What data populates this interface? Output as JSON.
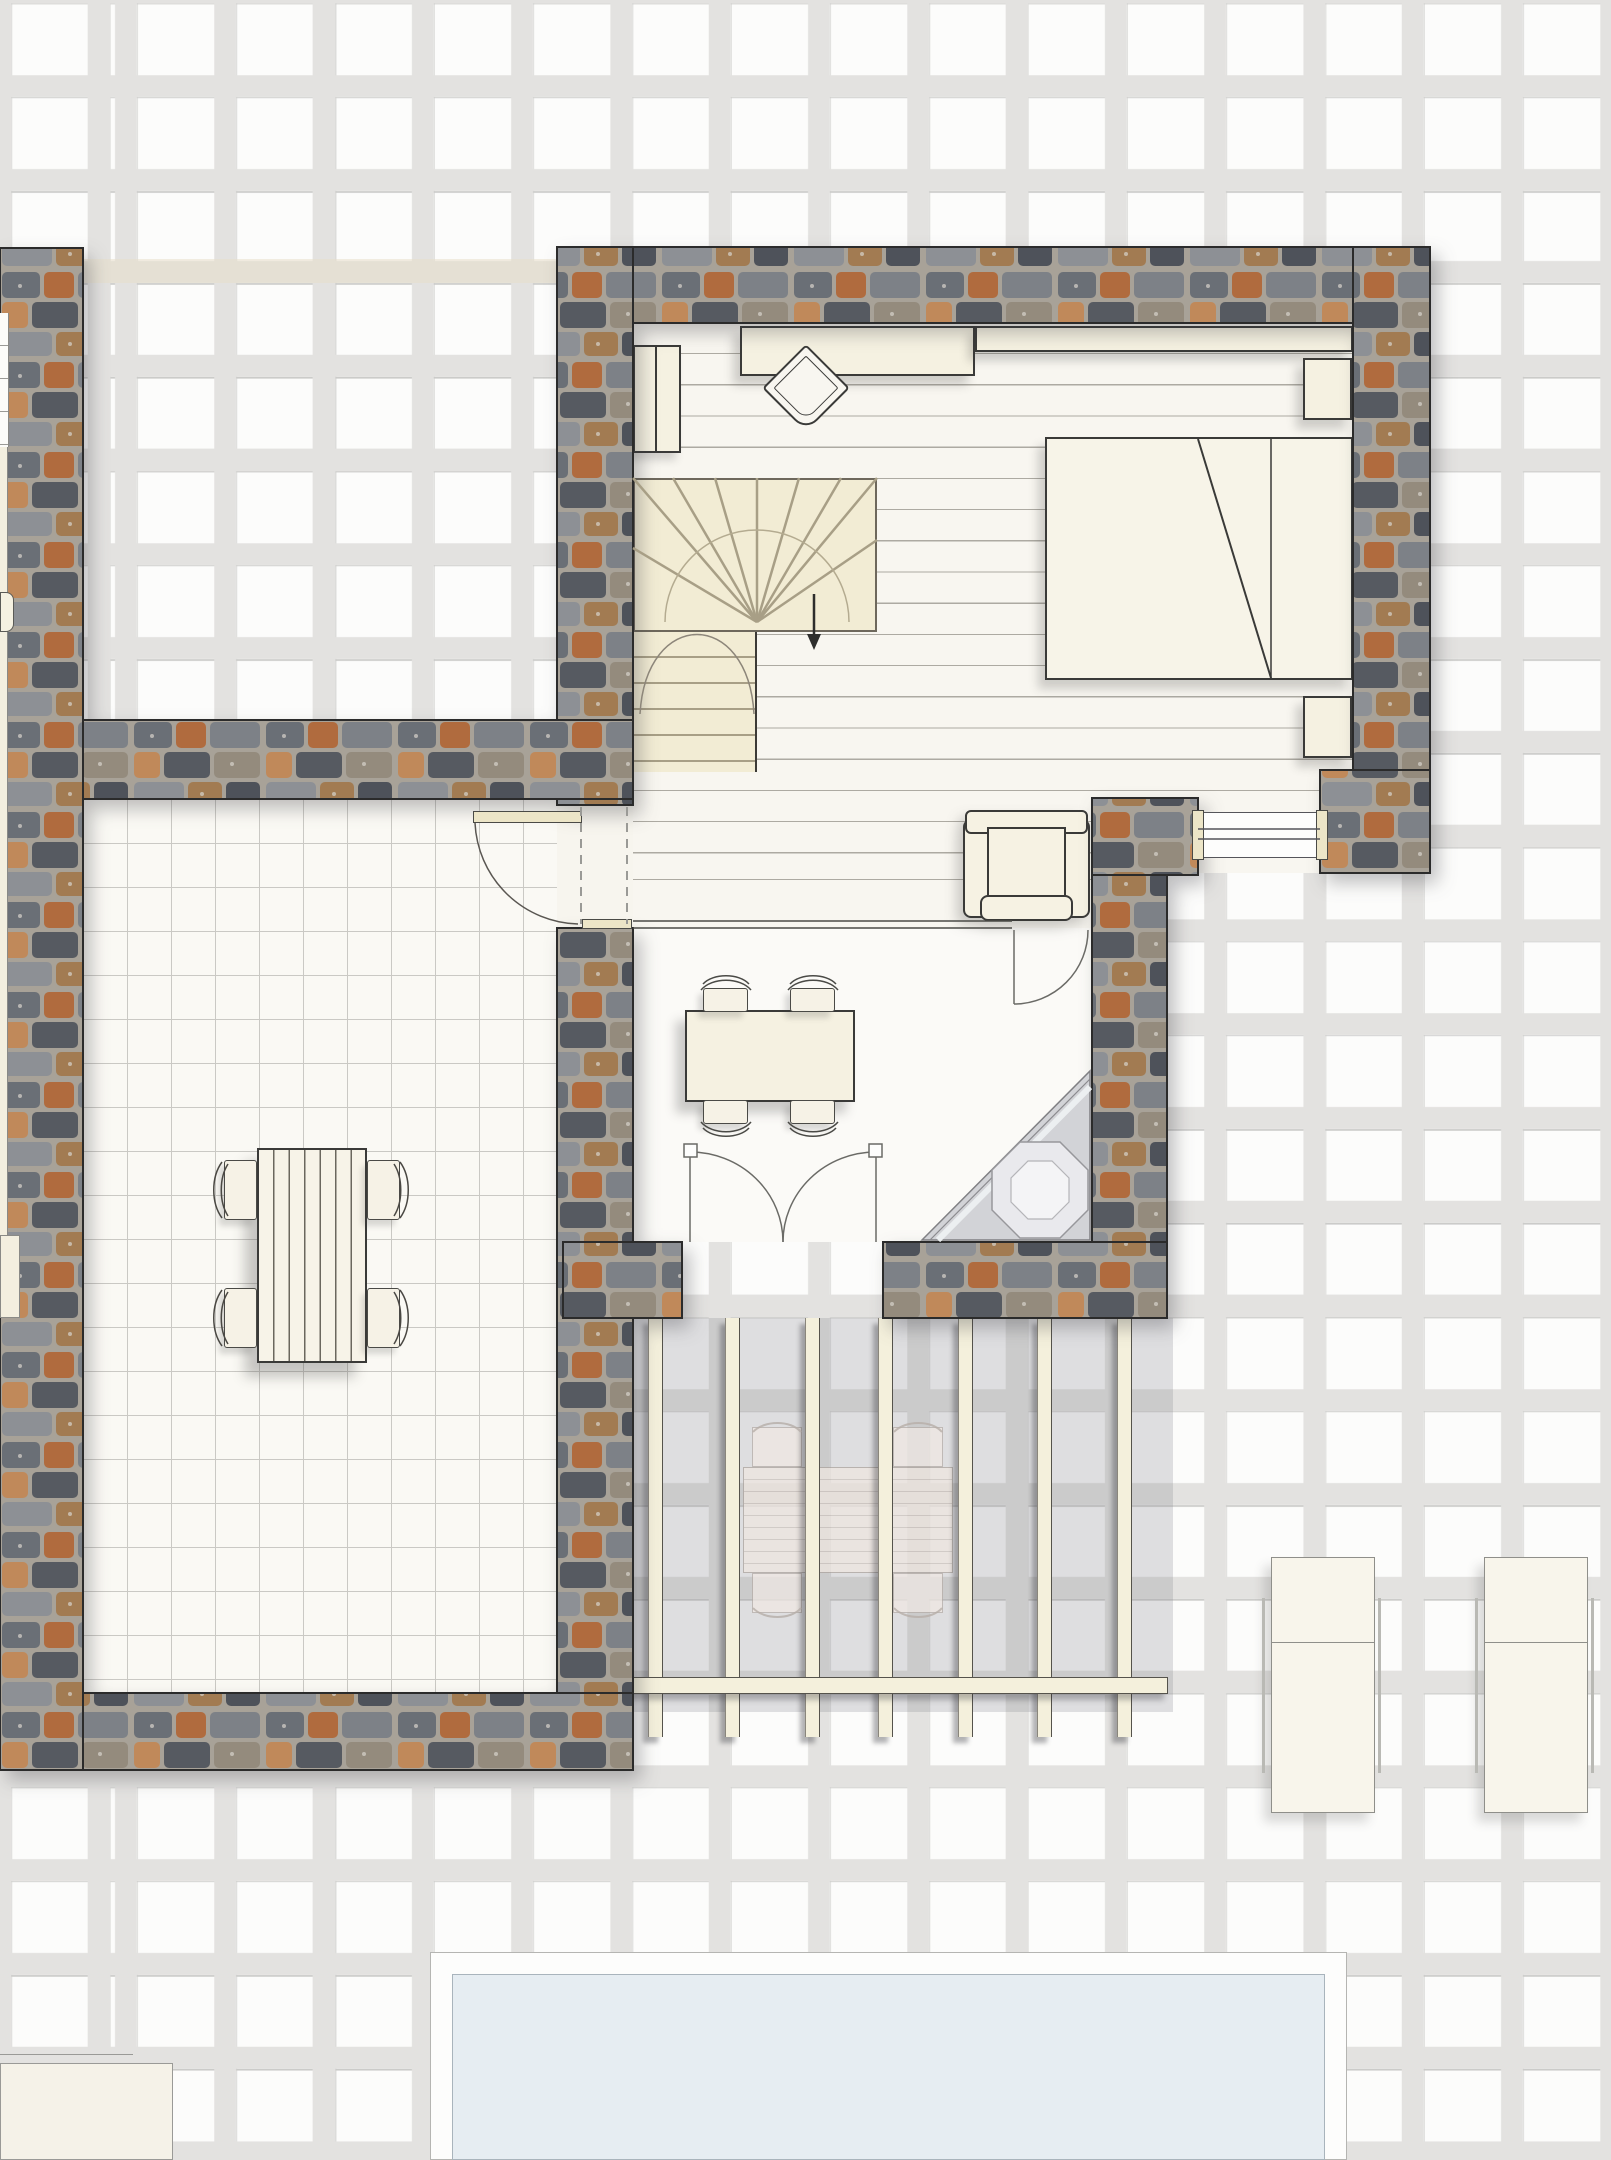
{
  "meta": {
    "type": "architectural-floor-plan",
    "view": "top-down",
    "text_visible_in_image": "none"
  },
  "colors": {
    "paver_tile": "#fcfcfb",
    "paver_grout": "#e3e2e0",
    "wood_floor": "#f8f6f0",
    "plank_line": "#adaaa2",
    "stair_fill": "#f2ecd4",
    "stair_line": "#a89f86",
    "furniture_cream": "#f5f1e1",
    "furniture_outline": "#3a3a38",
    "courtyard_floor": "#faf9f4",
    "courtyard_tile_line": "#cac9c4",
    "dining_floor": "#fbfaf7",
    "stone_mortar": "#a8a298",
    "stone_palette": [
      "#5b6068",
      "#757a80",
      "#8d9095",
      "#4e5158",
      "#b06b3e",
      "#c18a58",
      "#a87c4e",
      "#948b7d",
      "#6b707a"
    ],
    "pergola_beam": "#f4f0dc",
    "pergola_shade": "rgba(128,130,136,0.24)",
    "shower_gray": "#d2d3d7",
    "shower_light": "#e9e9ed",
    "pool_water": "#e6edf2",
    "pool_coping": "#fdfdfc",
    "lounger": "#f8f5eb"
  },
  "elements": {
    "bedroom": {
      "label": "bedroom with wood plank floor"
    },
    "bed": {
      "label": "double bed with folded duvet",
      "nightstands": 2
    },
    "desk": {
      "label": "desk against north wall"
    },
    "desk_chair": {
      "label": "desk chair"
    },
    "wall_shelf": {
      "label": "long wall shelf"
    },
    "wardrobe": {
      "label": "two-door wardrobe"
    },
    "stairs": {
      "label": "winder staircase going down",
      "direction": "down"
    },
    "hall": {
      "label": "hallway"
    },
    "armchair": {
      "label": "armchair"
    },
    "window": {
      "label": "east window"
    },
    "courtyard_door": {
      "label": "door to courtyard"
    },
    "dining_door": {
      "label": "door between hall and dining room"
    },
    "dining_room": {
      "label": "dining room"
    },
    "dining_table": {
      "label": "dining table",
      "chairs": 4
    },
    "french_doors": {
      "label": "double french doors to pergola terrace"
    },
    "corner_unit": {
      "label": "corner shower / fireplace unit"
    },
    "courtyard": {
      "label": "walled tiled courtyard"
    },
    "courtyard_table": {
      "label": "slatted garden table",
      "chairs": 4
    },
    "pergola": {
      "label": "slatted pergola canopy",
      "beams": 7
    },
    "outdoor_table": {
      "label": "outdoor table under pergola",
      "chairs": 4
    },
    "sun_lounger": {
      "label": "sun lounger",
      "count": 2
    },
    "pool": {
      "label": "swimming pool"
    },
    "neighbor_wall": {
      "label": "adjacent building stone wall"
    }
  }
}
